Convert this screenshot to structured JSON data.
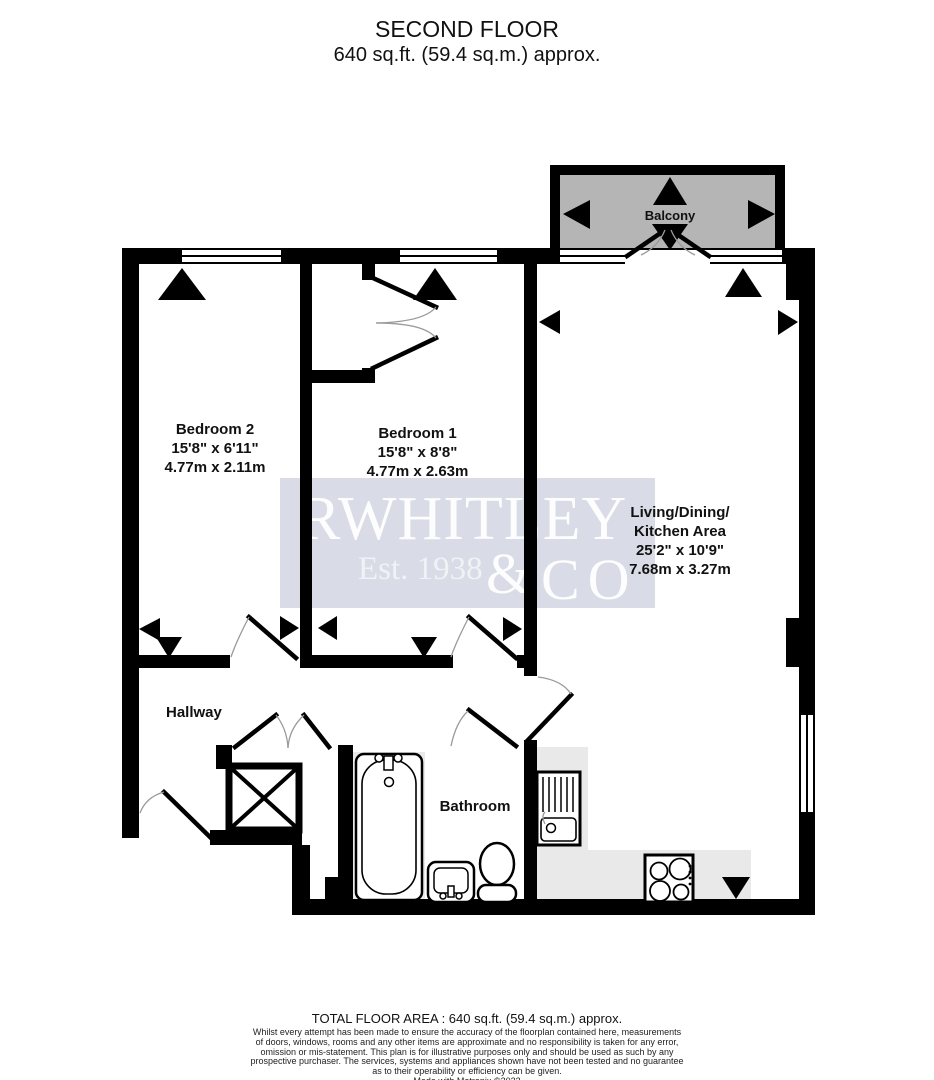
{
  "title": {
    "line1": "SECOND FLOOR",
    "line2": "640 sq.ft. (59.4 sq.m.) approx."
  },
  "rooms": {
    "balcony": {
      "name": "Balcony"
    },
    "bedroom2": {
      "name": "Bedroom 2",
      "imperial": "15'8\" x 6'11\"",
      "metric": "4.77m x 2.11m"
    },
    "bedroom1": {
      "name": "Bedroom 1",
      "imperial": "15'8\" x 8'8\"",
      "metric": "4.77m x 2.63m"
    },
    "living": {
      "name_line1": "Living/Dining/",
      "name_line2": "Kitchen Area",
      "imperial": "25'2\" x 10'9\"",
      "metric": "7.68m x 3.27m"
    },
    "hallway": {
      "name": "Hallway"
    },
    "bathroom": {
      "name": "Bathroom"
    }
  },
  "watermark": {
    "line1": "RWHITLEY",
    "est": "Est. 1938",
    "amp": "&",
    "co": "CO"
  },
  "footer": {
    "total": "TOTAL FLOOR AREA : 640 sq.ft. (59.4 sq.m.) approx.",
    "disclaimer_lines": [
      "Whilst every attempt has been made to ensure the accuracy of the floorplan contained here, measurements",
      "of doors, windows, rooms and any other items are approximate and no responsibility is taken for any error,",
      "omission or mis-statement. This plan is for illustrative purposes only and should be used as such by any",
      "prospective purchaser. The services, systems and appliances shown have not been tested and no guarantee",
      "as to their operability or efficiency can be given.",
      "Made with Metropix ©2023"
    ]
  },
  "colors": {
    "wall": "#000000",
    "balcony_fill": "#b5b5b5",
    "counter": "#e9e9e9",
    "watermark_band": "#d9dce6",
    "arc": "#9a9a9a"
  }
}
